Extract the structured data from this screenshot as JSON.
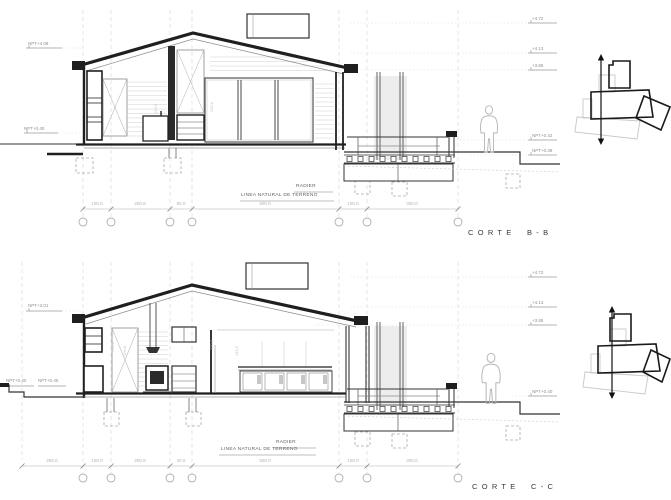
{
  "sheet": {
    "background": "#ffffff",
    "ink": "#1f1f1f",
    "light_gray": "#c8c8c8"
  },
  "sections": {
    "top": {
      "title": "CORTE B-B",
      "levels_left": [
        "NPT+4.08",
        "NPT+0.40"
      ],
      "levels_right": [
        "+4.72",
        "+4.13",
        "+3.85",
        "NPT+0.42",
        "NPT+0.38"
      ],
      "radier": "RADIER",
      "terreno": "LINEA NATURAL DE TERRENO",
      "dims": [
        "100.0",
        "200.8",
        "80.0",
        "500.0",
        "100.0",
        "300.0"
      ],
      "vdims": [
        "220.0",
        "240.0"
      ]
    },
    "bottom": {
      "title": "CORTE C-C",
      "levels_left": [
        "NPT+2.01",
        "NPT+0.40",
        "NPT+0.45"
      ],
      "levels_right": [
        "+4.72",
        "+4.13",
        "+3.85",
        "NPT+0.40"
      ],
      "radier": "RADIER",
      "terreno": "LINEA NATURAL DE TERRENO",
      "dims": [
        "250.0",
        "100.0",
        "200.8",
        "40.0",
        "500.0",
        "100.0",
        "300.0"
      ],
      "vdims": [
        "240.0",
        "220.0",
        "145.0",
        "100.8"
      ]
    }
  }
}
